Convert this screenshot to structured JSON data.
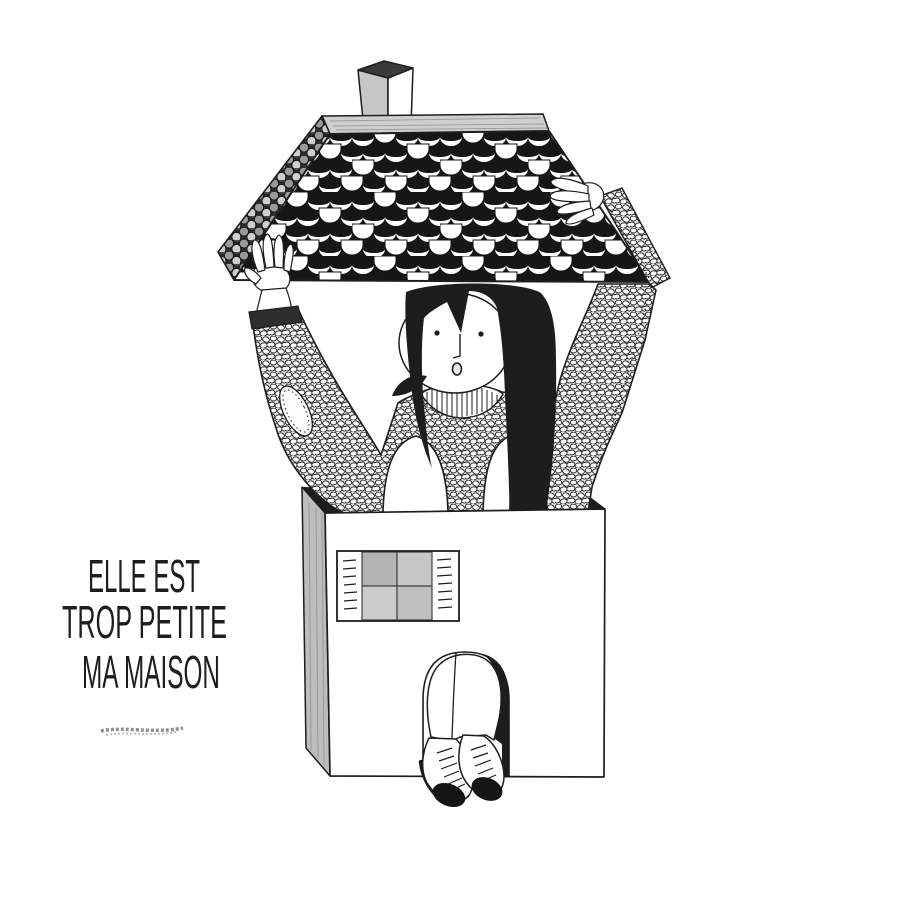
{
  "caption": {
    "lines": [
      "ELLE EST",
      "TROP PETITE",
      "MA MAISON"
    ]
  },
  "colors": {
    "ink": "#1d1d1d",
    "paper": "#ffffff",
    "pencil": "#c2c2c2",
    "roof_black": "#161616",
    "pane_gray": "#bfbfbf"
  }
}
